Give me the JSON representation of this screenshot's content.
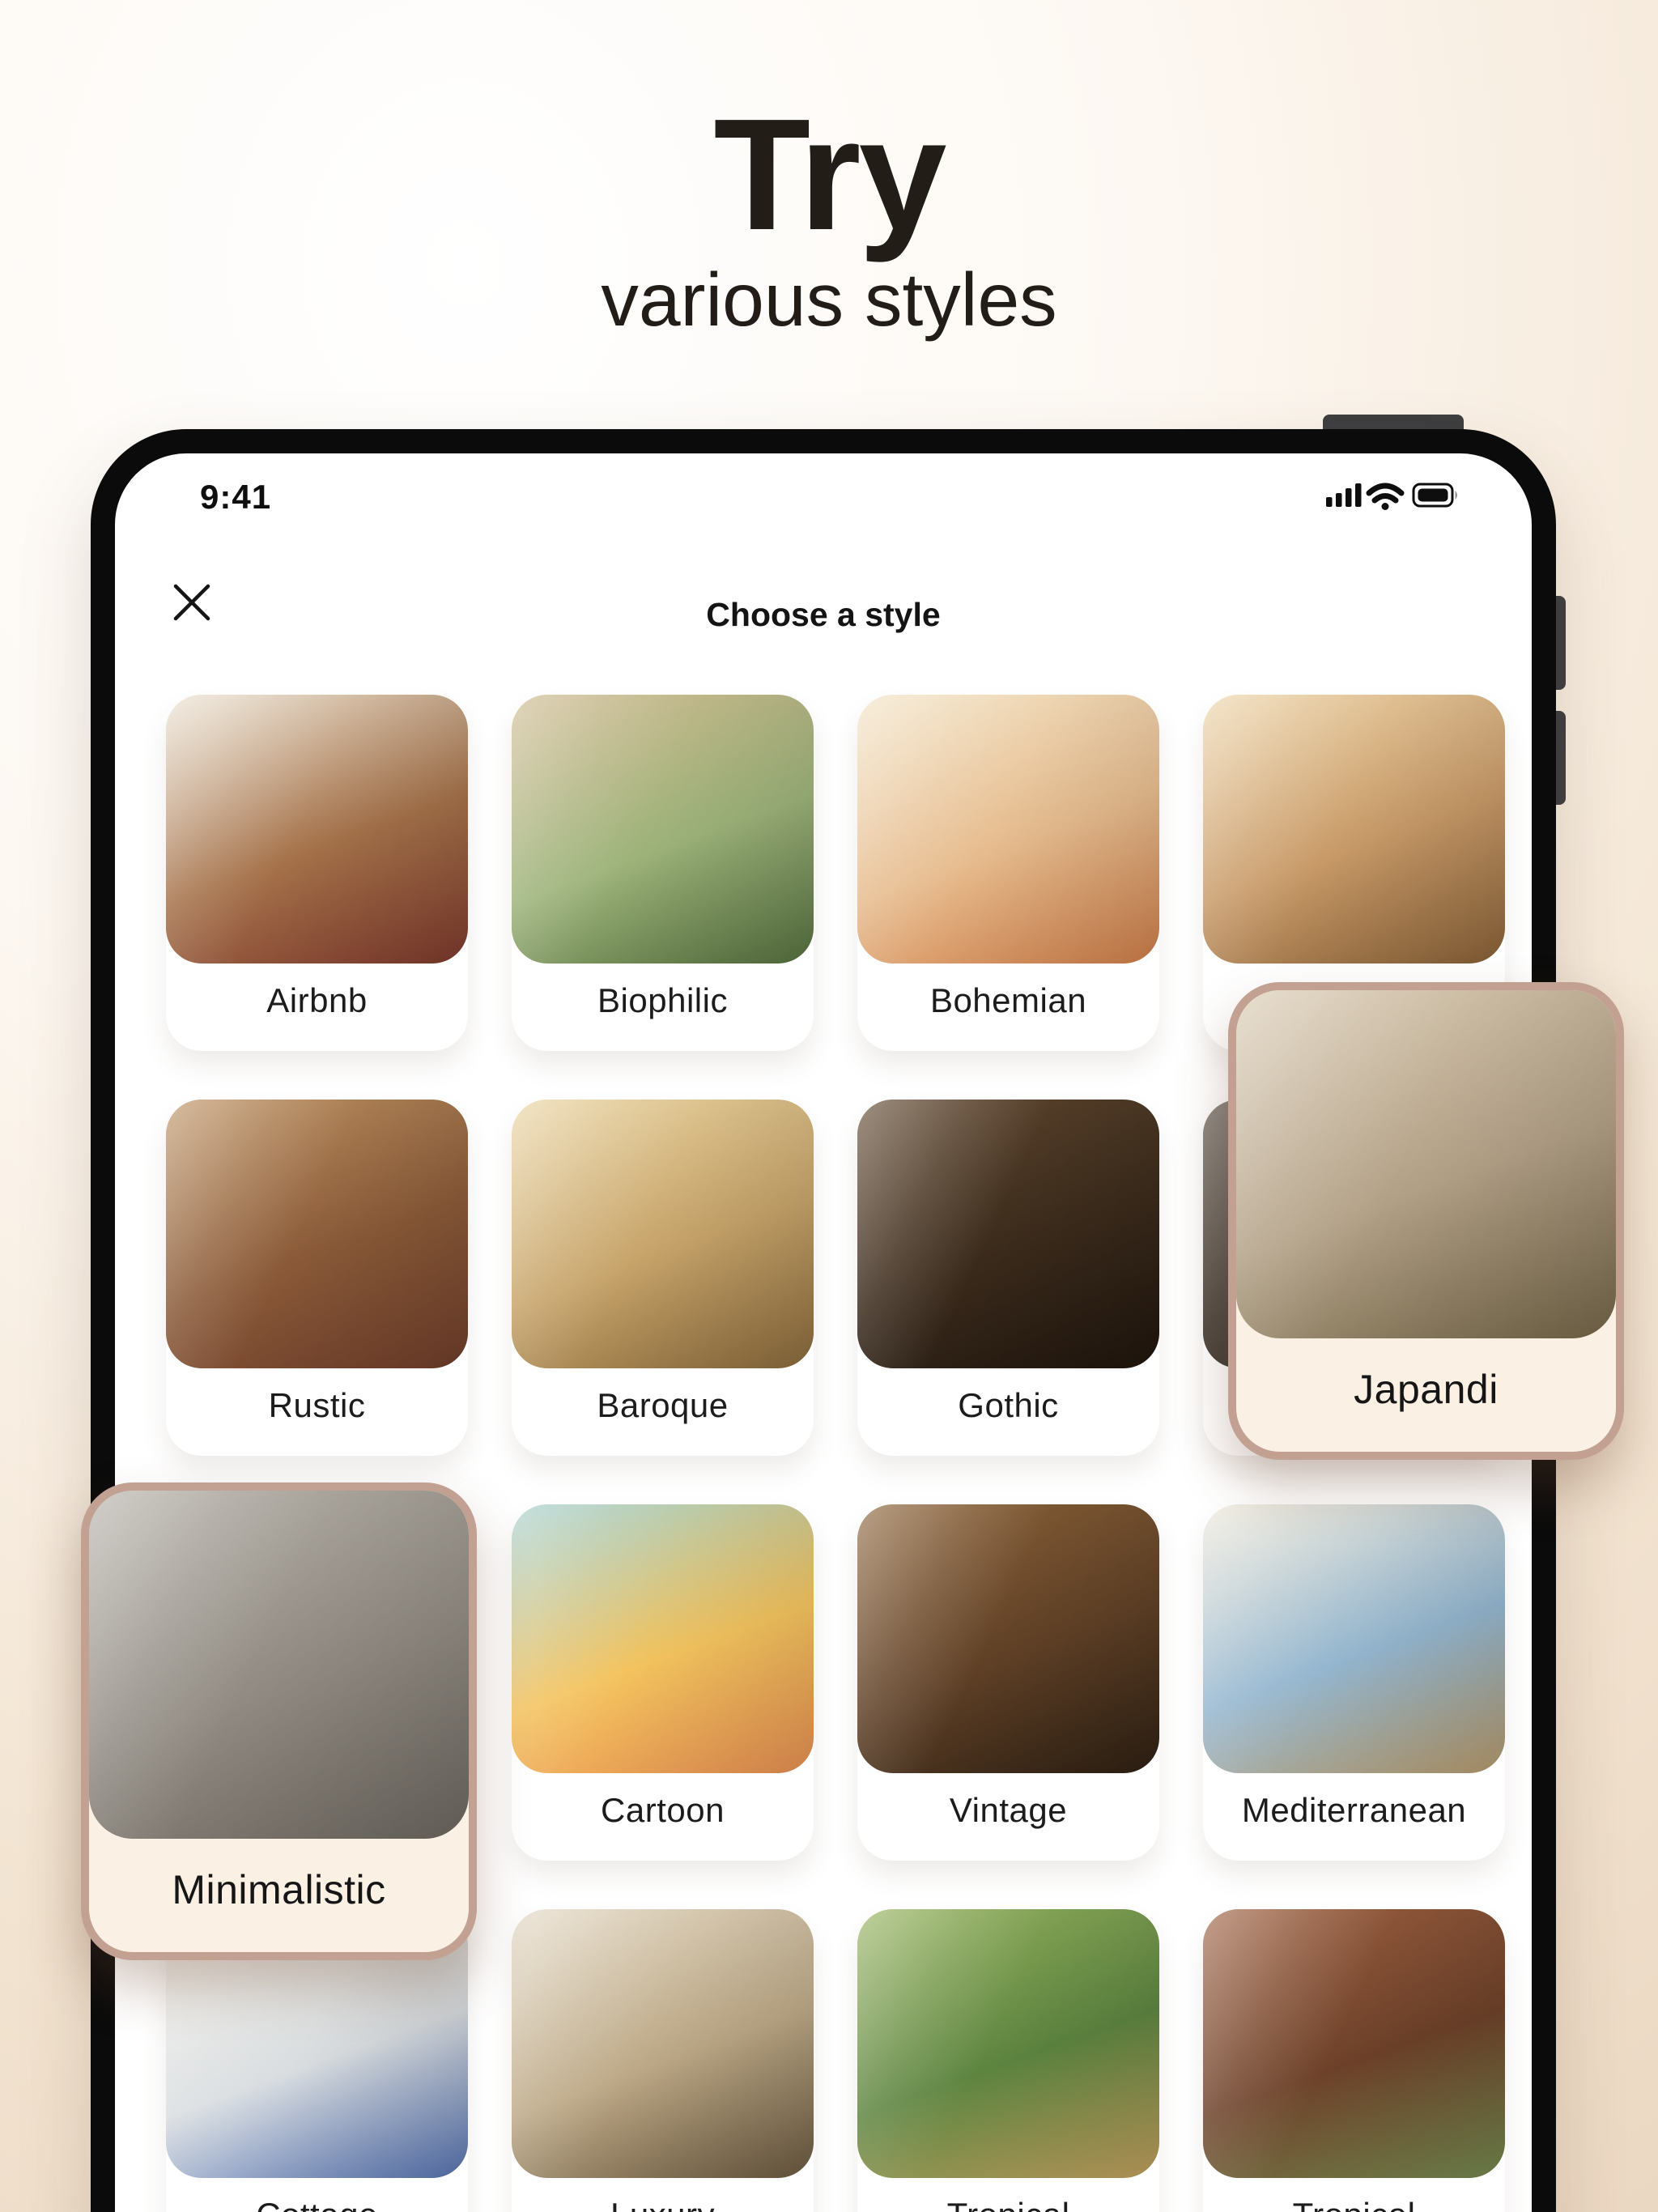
{
  "hero": {
    "title": "Try",
    "subtitle": "various styles"
  },
  "device": {
    "status_bar": {
      "time": "9:41",
      "icons": [
        "cellular-signal-icon",
        "wifi-icon",
        "battery-icon"
      ]
    },
    "header": {
      "title": "Choose a style",
      "close_icon": "close-icon"
    }
  },
  "colors": {
    "selected_border": "#c2a192",
    "selected_label_bg": "#fbf0e4",
    "card_bg": "#ffffff",
    "label_text": "#1c1c1c",
    "frame": "#0b0b0b",
    "page_gradient": [
      "#ffffff",
      "#f6ebdd",
      "#e8d3bc"
    ]
  },
  "styles": [
    {
      "id": "airbnb",
      "label": "Airbnb",
      "selected": false,
      "palette": [
        "#eae1d1",
        "#a5724a",
        "#7e392c"
      ]
    },
    {
      "id": "biophilic",
      "label": "Biophilic",
      "selected": false,
      "palette": [
        "#cdb88e",
        "#9db37a",
        "#56713f"
      ]
    },
    {
      "id": "bohemian",
      "label": "Bohemian",
      "selected": false,
      "palette": [
        "#f2e3c6",
        "#e6bb8d",
        "#cf7e49"
      ]
    },
    {
      "id": "covered-1",
      "label": "",
      "selected": false,
      "palette": [
        "#ecd3a8",
        "#c89a68",
        "#8a6238"
      ]
    },
    {
      "id": "rustic",
      "label": "Rustic",
      "selected": false,
      "palette": [
        "#bb9061",
        "#8a5a38",
        "#6e3d2a"
      ]
    },
    {
      "id": "baroque",
      "label": "Baroque",
      "selected": false,
      "palette": [
        "#e8d2a0",
        "#c6a369",
        "#8a6a3c"
      ]
    },
    {
      "id": "gothic",
      "label": "Gothic",
      "selected": false,
      "palette": [
        "#5f462e",
        "#3a2a1b",
        "#1f150d"
      ]
    },
    {
      "id": "covered-2",
      "label": "",
      "selected": false,
      "palette": [
        "#4d443a",
        "#372f27",
        "#2a241d"
      ]
    },
    {
      "id": "japandi",
      "label": "Japandi",
      "selected": true,
      "palette": [
        "#d8c9b1",
        "#b2a086",
        "#746648"
      ]
    },
    {
      "id": "minimalistic",
      "label": "Minimalistic",
      "selected": true,
      "palette": [
        "#b3aea6",
        "#908a82",
        "#6d6760"
      ]
    },
    {
      "id": "cartoon",
      "label": "Cartoon",
      "selected": false,
      "palette": [
        "#9ecccb",
        "#f3c35e",
        "#e78f52"
      ]
    },
    {
      "id": "vintage",
      "label": "Vintage",
      "selected": false,
      "palette": [
        "#8a6137",
        "#5f4026",
        "#2e2013"
      ]
    },
    {
      "id": "mediterranean",
      "label": "Mediterranean",
      "selected": false,
      "palette": [
        "#ece6d7",
        "#94b6cf",
        "#b79a6b"
      ]
    },
    {
      "id": "cottage",
      "label": "Cottage",
      "selected": false,
      "palette": [
        "#efece3",
        "#d9dde0",
        "#5572b0"
      ]
    },
    {
      "id": "luxury",
      "label": "Luxury",
      "selected": false,
      "palette": [
        "#e2d7c3",
        "#bca886",
        "#6b5940"
      ]
    },
    {
      "id": "tropical",
      "label": "Tropical",
      "selected": false,
      "palette": [
        "#93b05c",
        "#5d8440",
        "#c2a05e"
      ]
    },
    {
      "id": "tropical-2",
      "label": "Tropical",
      "selected": false,
      "palette": [
        "#9c5f40",
        "#6d4129",
        "#74894f"
      ]
    }
  ]
}
